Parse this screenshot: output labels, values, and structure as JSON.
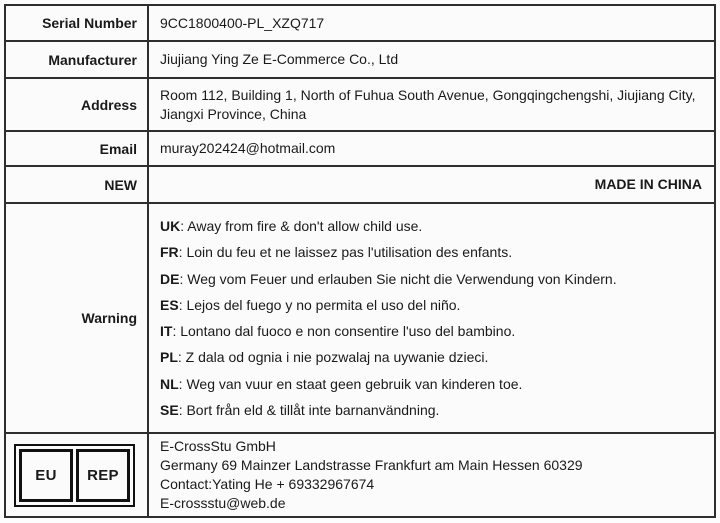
{
  "colors": {
    "border": "#2e2e2e",
    "text": "#1a1a1a",
    "background": "#fbfbfb"
  },
  "info_rows": [
    {
      "label": "Serial Number",
      "value": "9CC1800400-PL_XZQ717"
    },
    {
      "label": "Manufacturer",
      "value": "Jiujiang Ying Ze E-Commerce Co., Ltd"
    },
    {
      "label": "Address",
      "value": "Room 112, Building 1, North of Fuhua South Avenue, Gongqingchengshi, Jiujiang City, Jiangxi Province, China"
    },
    {
      "label": "Email",
      "value": "muray202424@hotmail.com"
    }
  ],
  "origin_row": {
    "label": "NEW",
    "value": "MADE IN CHINA"
  },
  "warning": {
    "label": "Warning",
    "separator": ": ",
    "items": [
      {
        "lang": "UK",
        "text": "Away from fire & don't allow child use."
      },
      {
        "lang": "FR",
        "text": "Loin du feu et ne laissez pas l'utilisation des enfants."
      },
      {
        "lang": "DE",
        "text": "Weg vom Feuer und erlauben Sie nicht die Verwendung von Kindern."
      },
      {
        "lang": "ES",
        "text": "Lejos del fuego y no permita el uso del niño."
      },
      {
        "lang": "IT",
        "text": "Lontano dal fuoco e non consentire l'uso del bambino."
      },
      {
        "lang": "PL",
        "text": "Z dala od ognia i nie pozwalaj na uywanie dzieci."
      },
      {
        "lang": "NL",
        "text": "Weg van vuur en staat geen gebruik van kinderen toe."
      },
      {
        "lang": "SE",
        "text": "Bort från eld & tillåt inte barnanvändning."
      }
    ]
  },
  "eu_rep": {
    "box_left": "EU",
    "box_right": "REP",
    "lines": [
      "E-CrossStu GmbH",
      "Germany 69 Mainzer Landstrasse Frankfurt am Main Hessen 60329",
      "Contact:Yating He + 69332967674",
      "E-crossstu@web.de"
    ]
  }
}
